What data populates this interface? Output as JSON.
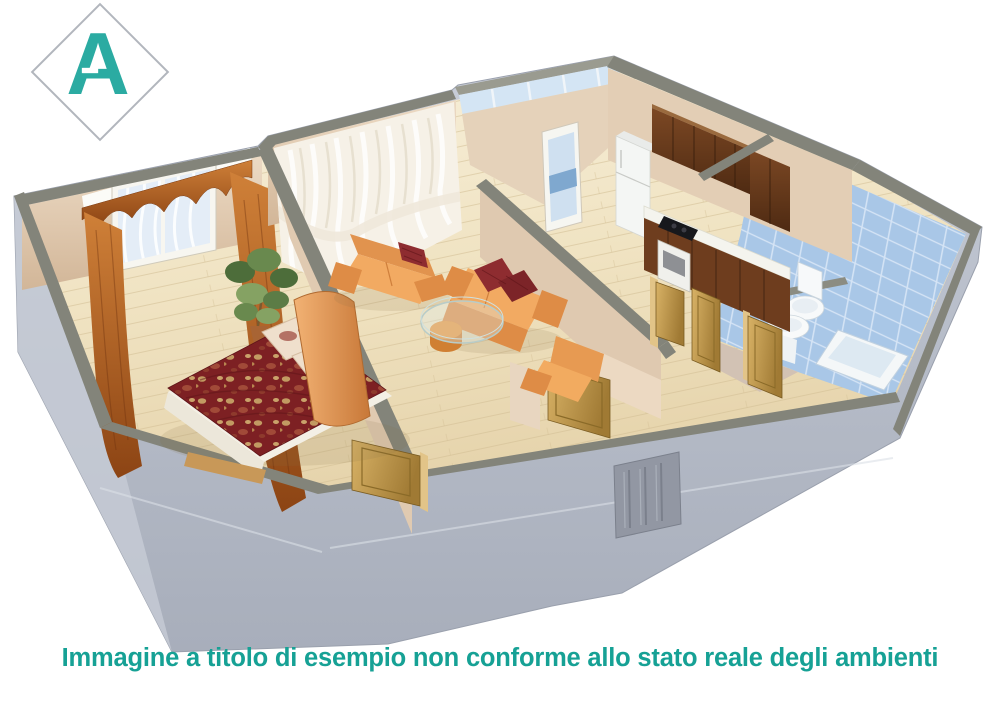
{
  "window": {
    "width": 1000,
    "height": 707,
    "background": "#ffffff"
  },
  "logo": {
    "letter": "A",
    "letter_color": "#2BABA2",
    "diamond_fill": "#ffffff",
    "diamond_border_color": "#b2b6bd"
  },
  "caption": {
    "text": "Immagine a titolo di esempio non conforme allo stato reale degli ambienti",
    "color": "#16A195"
  },
  "floorplan": {
    "description": "3D isometric cutaway floor plan of an apartment, viewed from above",
    "rooms": [
      {
        "name": "bedroom",
        "position": "left",
        "items": [
          "double bed with dark red patterned cover",
          "two patterned pillows",
          "orange curved headboard",
          "window with rust curtains and scalloped valance",
          "potted plant"
        ]
      },
      {
        "name": "living-room",
        "position": "center",
        "items": [
          "two orange sofas with dark red cushions",
          "orange armchair",
          "oval glass coffee table with round orange stool",
          "white sheer curtains"
        ]
      },
      {
        "name": "kitchen",
        "position": "top-right",
        "items": [
          "dark wood upper cabinets",
          "white refrigerator",
          "base cabinets with white countertop",
          "black cooktop",
          "white oven",
          "balcony glazing",
          "balcony window-door"
        ]
      },
      {
        "name": "bathroom",
        "position": "right",
        "items": [
          "light blue wall tiles",
          "toilet",
          "pedestal sink",
          "bathtub",
          "low gray partition"
        ]
      },
      {
        "name": "hallway",
        "position": "front",
        "items": [
          "open wooden interior doors",
          "gray paneled entry door"
        ]
      }
    ],
    "colors": {
      "outer_wall": "#b9bfca",
      "wall_top_band": "#84857b",
      "inner_wall_beige": "#ddc7ae",
      "floor_wood": "#f0e3c2",
      "bathroom_tile_blue": "#a9c7e7",
      "sofa_orange": "#f0a55c",
      "bed_cover_red": "#7d2023",
      "door_wood": "#c9a352",
      "curtain_rust": "#b05a28",
      "entry_door_gray": "#9297a3",
      "balcony_glass": "#d4e5f4"
    }
  }
}
